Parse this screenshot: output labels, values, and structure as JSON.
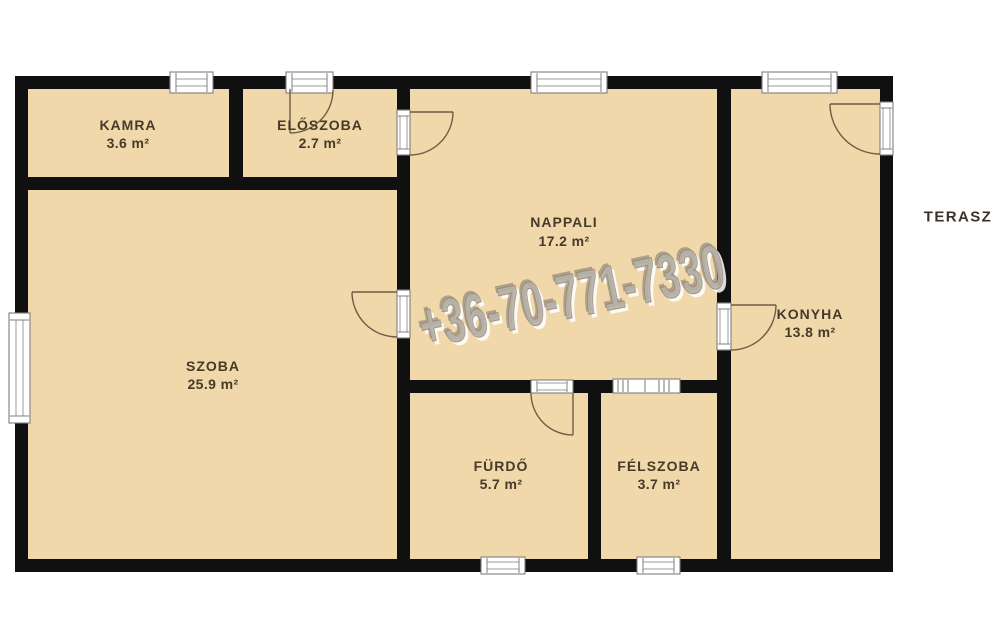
{
  "plan": {
    "rooms": [
      {
        "name": "KAMRA",
        "area": "3.6 m²"
      },
      {
        "name": "ELŐSZOBA",
        "area": "2.7 m²"
      },
      {
        "name": "NAPPALI",
        "area": "17.2 m²"
      },
      {
        "name": "SZOBA",
        "area": "25.9 m²"
      },
      {
        "name": "FÜRDŐ",
        "area": "5.7 m²"
      },
      {
        "name": "FÉLSZOBA",
        "area": "3.7 m²"
      },
      {
        "name": "KONYHA",
        "area": "13.8 m²"
      }
    ],
    "outside_label": "TERASZ",
    "watermark_phone": "+36-70-771-7330",
    "colors": {
      "floor": "#f0d8ab",
      "wall": "#101010",
      "label_text": "#463a28",
      "door_swing": "#6f5e46",
      "watermark": "#b6b0a6",
      "background": "#ffffff"
    }
  }
}
